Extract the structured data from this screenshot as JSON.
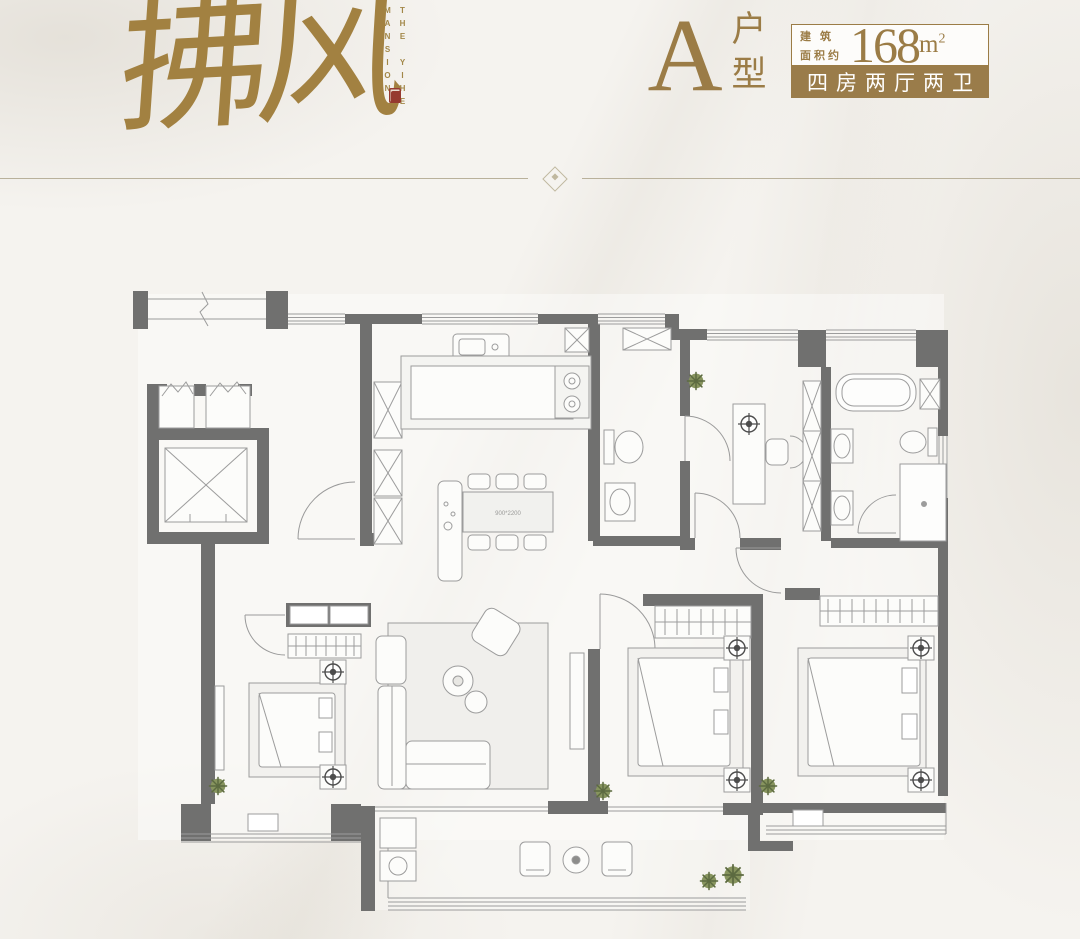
{
  "page": {
    "width": 1080,
    "height": 939,
    "background": "#f5f3ef"
  },
  "colors": {
    "gold": "#9b7c46",
    "calligraphy_gold": "#a28141",
    "badge_background": "#9a7c4a",
    "badge_text": "#ffffff",
    "seal_red": "#963a30",
    "divider_line": "#b9b19b",
    "wall_gray": "#70706f",
    "furniture_line": "#9c9c9c",
    "plant_green": "#77854f"
  },
  "brand": {
    "calligraphy": "拂风",
    "caption_column_left": "MANSION",
    "caption_column_right": "THE YIHE",
    "seal_icon": "red-seal-stamp"
  },
  "header": {
    "unit_letter": "A",
    "unit_label_top": "户",
    "unit_label_bottom": "型",
    "area_label_line1": "建 筑",
    "area_label_line2": "面积约",
    "area_value": "168",
    "area_unit": "m",
    "area_exponent": "2",
    "type_badge": "四房两厅两卫"
  },
  "floorplan": {
    "dining_table_label": "900*2200",
    "fixtures": [
      "elevator",
      "vent-shafts",
      "entry-door",
      "pantry-cabinets",
      "kitchen-sink",
      "kitchen-counter",
      "stove",
      "fridge",
      "guest-toilet",
      "guest-vanity",
      "kitchen-island",
      "dining-table",
      "dining-chairs",
      "study-desk",
      "office-chair",
      "bookshelf",
      "bathtub",
      "double-vanity",
      "master-toilet",
      "shower",
      "walk-in-closet",
      "bed-1",
      "bed-2",
      "bed-3",
      "wardrobes",
      "nightstand-lamps",
      "sofa",
      "armchair",
      "coffee-tables",
      "living-rug",
      "tv-console",
      "balcony-chairs",
      "balcony-table",
      "balcony-cabinet",
      "bay-window-pillows",
      "plants"
    ]
  }
}
